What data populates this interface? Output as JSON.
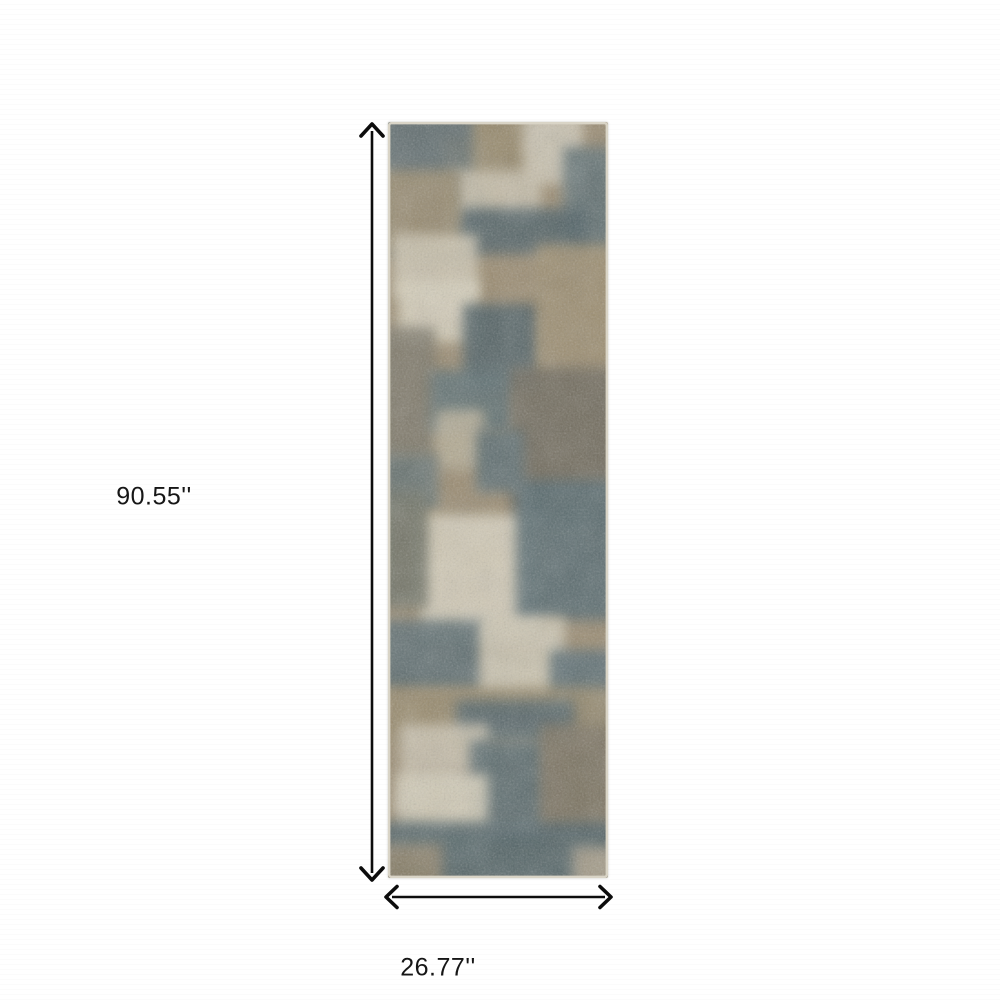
{
  "dimensions": {
    "height_label": "90.55''",
    "width_label": "26.77''"
  },
  "colors": {
    "background": "#ffffff",
    "arrow": "#0c0c0c",
    "label_text": "#161616"
  },
  "rug": {
    "x": 388,
    "y": 122,
    "width": 220,
    "height": 756,
    "base_color": "#9a8b70",
    "edge_color": "#d9d4c6",
    "blur": 6,
    "grain_opacity": 0.3,
    "mottle_opacity": 0.18,
    "palette": {
      "teal": "#57696d",
      "dark_teal": "#4d5f63",
      "cream": "#d6cfba",
      "tan": "#9a8b70",
      "olive_brown": "#6d675a",
      "grey": "#7b7767"
    },
    "patches": [
      [
        -8,
        -8,
        100,
        140,
        "#5a6b6e"
      ],
      [
        55,
        15,
        45,
        75,
        "#6d7672"
      ],
      [
        85,
        -8,
        70,
        75,
        "#968869"
      ],
      [
        135,
        -8,
        60,
        70,
        "#cfc8b6"
      ],
      [
        175,
        25,
        53,
        110,
        "#5b6d70"
      ],
      [
        68,
        48,
        85,
        52,
        "#c8c0ab"
      ],
      [
        70,
        86,
        130,
        46,
        "#4d5f63"
      ],
      [
        -8,
        48,
        80,
        85,
        "#9a8b6d"
      ],
      [
        5,
        112,
        85,
        65,
        "#ccc4af"
      ],
      [
        10,
        158,
        80,
        62,
        "#d7d0bc"
      ],
      [
        75,
        182,
        78,
        85,
        "#4d5f63"
      ],
      [
        148,
        122,
        80,
        140,
        "#9c8d6e"
      ],
      [
        -8,
        205,
        55,
        130,
        "#7b7767"
      ],
      [
        42,
        248,
        85,
        62,
        "#5c6e71"
      ],
      [
        48,
        288,
        48,
        58,
        "#b6ad95"
      ],
      [
        122,
        245,
        106,
        160,
        "#6d675a"
      ],
      [
        88,
        308,
        48,
        62,
        "#596b6e"
      ],
      [
        -8,
        332,
        58,
        58,
        "#647170"
      ],
      [
        -8,
        390,
        120,
        60,
        "#988a6c"
      ],
      [
        32,
        392,
        118,
        125,
        "#d6cfbb"
      ],
      [
        128,
        358,
        100,
        140,
        "#55696e"
      ],
      [
        -8,
        368,
        48,
        118,
        "#6f7366"
      ],
      [
        -8,
        498,
        105,
        72,
        "#5a6c70"
      ],
      [
        92,
        495,
        85,
        85,
        "#cec7b3"
      ],
      [
        162,
        528,
        66,
        82,
        "#586c72"
      ],
      [
        -8,
        565,
        236,
        55,
        "#97896b"
      ],
      [
        68,
        578,
        118,
        42,
        "#516368"
      ],
      [
        12,
        602,
        88,
        88,
        "#c9c1ad"
      ],
      [
        82,
        618,
        78,
        100,
        "#57696d"
      ],
      [
        152,
        602,
        76,
        128,
        "#79715f"
      ],
      [
        8,
        652,
        92,
        88,
        "#d3ccb8"
      ],
      [
        -8,
        700,
        236,
        64,
        "#506266"
      ],
      [
        -8,
        722,
        62,
        42,
        "#8c8067"
      ],
      [
        185,
        725,
        43,
        39,
        "#a99e88"
      ]
    ]
  },
  "arrows": {
    "vertical": {
      "x": 372,
      "top": 123,
      "bottom": 881
    },
    "horizontal": {
      "y": 897,
      "left": 385,
      "right": 612
    }
  }
}
